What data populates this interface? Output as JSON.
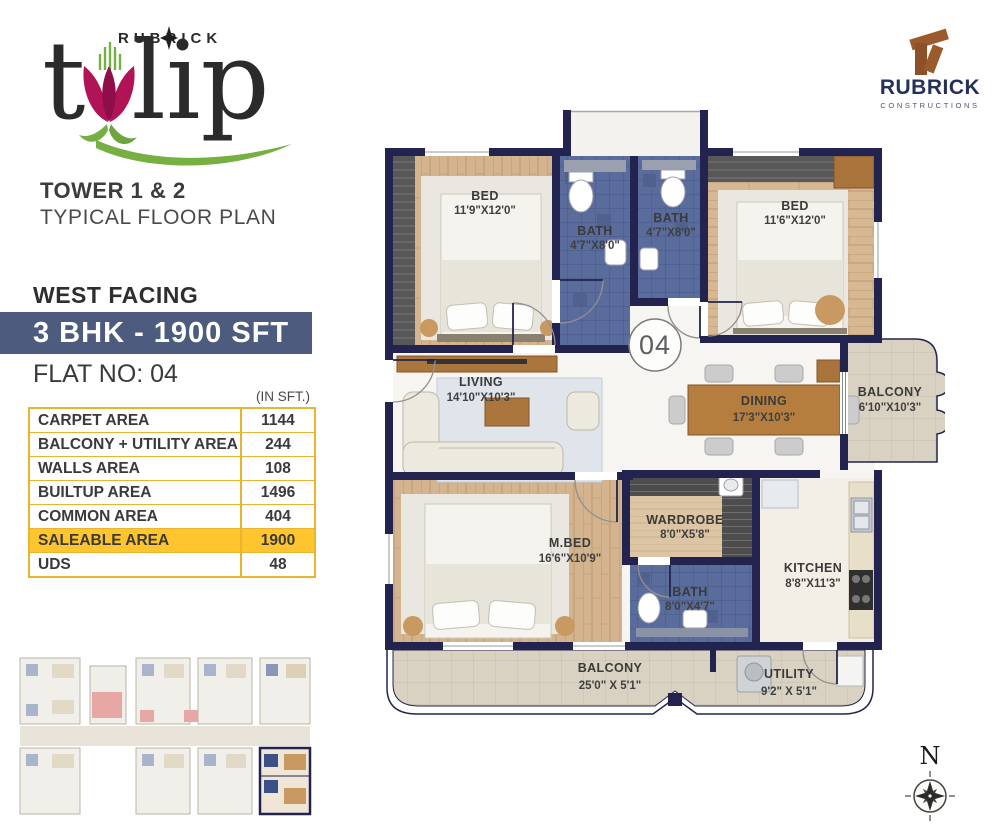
{
  "branding": {
    "logo_top": "RUBRICK",
    "logo_t": "t",
    "logo_lip": "lip"
  },
  "header": {
    "tower": "TOWER 1 & 2",
    "plan_type": "TYPICAL FLOOR PLAN"
  },
  "company": {
    "name": "RUBRICK",
    "tagline": "CONSTRUCTIONS"
  },
  "info": {
    "facing": "WEST FACING",
    "unit_banner": "3 BHK - 1900 SFT",
    "flat_no": "FLAT NO: 04",
    "units_note": "(IN SFT.)"
  },
  "area_table": {
    "rows": [
      {
        "label": "CARPET AREA",
        "value": "1144"
      },
      {
        "label": "BALCONY + UTILITY AREA",
        "value": "244"
      },
      {
        "label": "WALLS AREA",
        "value": "108"
      },
      {
        "label": "BUILTUP AREA",
        "value": "1496"
      },
      {
        "label": "COMMON AREA",
        "value": "404"
      },
      {
        "label": "SALEABLE AREA",
        "value": "1900"
      },
      {
        "label": "UDS",
        "value": "48"
      }
    ]
  },
  "floor_plan": {
    "unit_number": "04",
    "rooms": [
      {
        "name": "BED",
        "dims": "11'9\"X12'0\""
      },
      {
        "name": "BATH",
        "dims": "4'7\"X8'0\""
      },
      {
        "name": "BATH",
        "dims": "4'7\"X8'0\""
      },
      {
        "name": "BED",
        "dims": "11'6\"X12'0\""
      },
      {
        "name": "LIVING",
        "dims": "14'10\"X10'3\""
      },
      {
        "name": "DINING",
        "dims": "17'3\"X10'3\""
      },
      {
        "name": "BALCONY",
        "dims": "6'10\"X10'3\""
      },
      {
        "name": "M.BED",
        "dims": "16'6\"X10'9\""
      },
      {
        "name": "WARDROBE",
        "dims": "8'0\"X5'8\""
      },
      {
        "name": "BATH",
        "dims": "8'0\"X4'7\""
      },
      {
        "name": "KITCHEN",
        "dims": "8'8\"X11'3\""
      },
      {
        "name": "BALCONY",
        "dims": "25'0\" X 5'1\""
      },
      {
        "name": "UTILITY",
        "dims": "9'2\" X 5'1\""
      }
    ]
  },
  "compass": {
    "north": "N"
  },
  "colors": {
    "wall_navy": "#23234F",
    "banner_blue": "#4D5C7E",
    "accent_gold": "#FFC52E",
    "logo_magenta": "#B01356",
    "logo_green": "#76B043",
    "brand_brown": "#9A5A2C",
    "brand_navy": "#25315A"
  }
}
